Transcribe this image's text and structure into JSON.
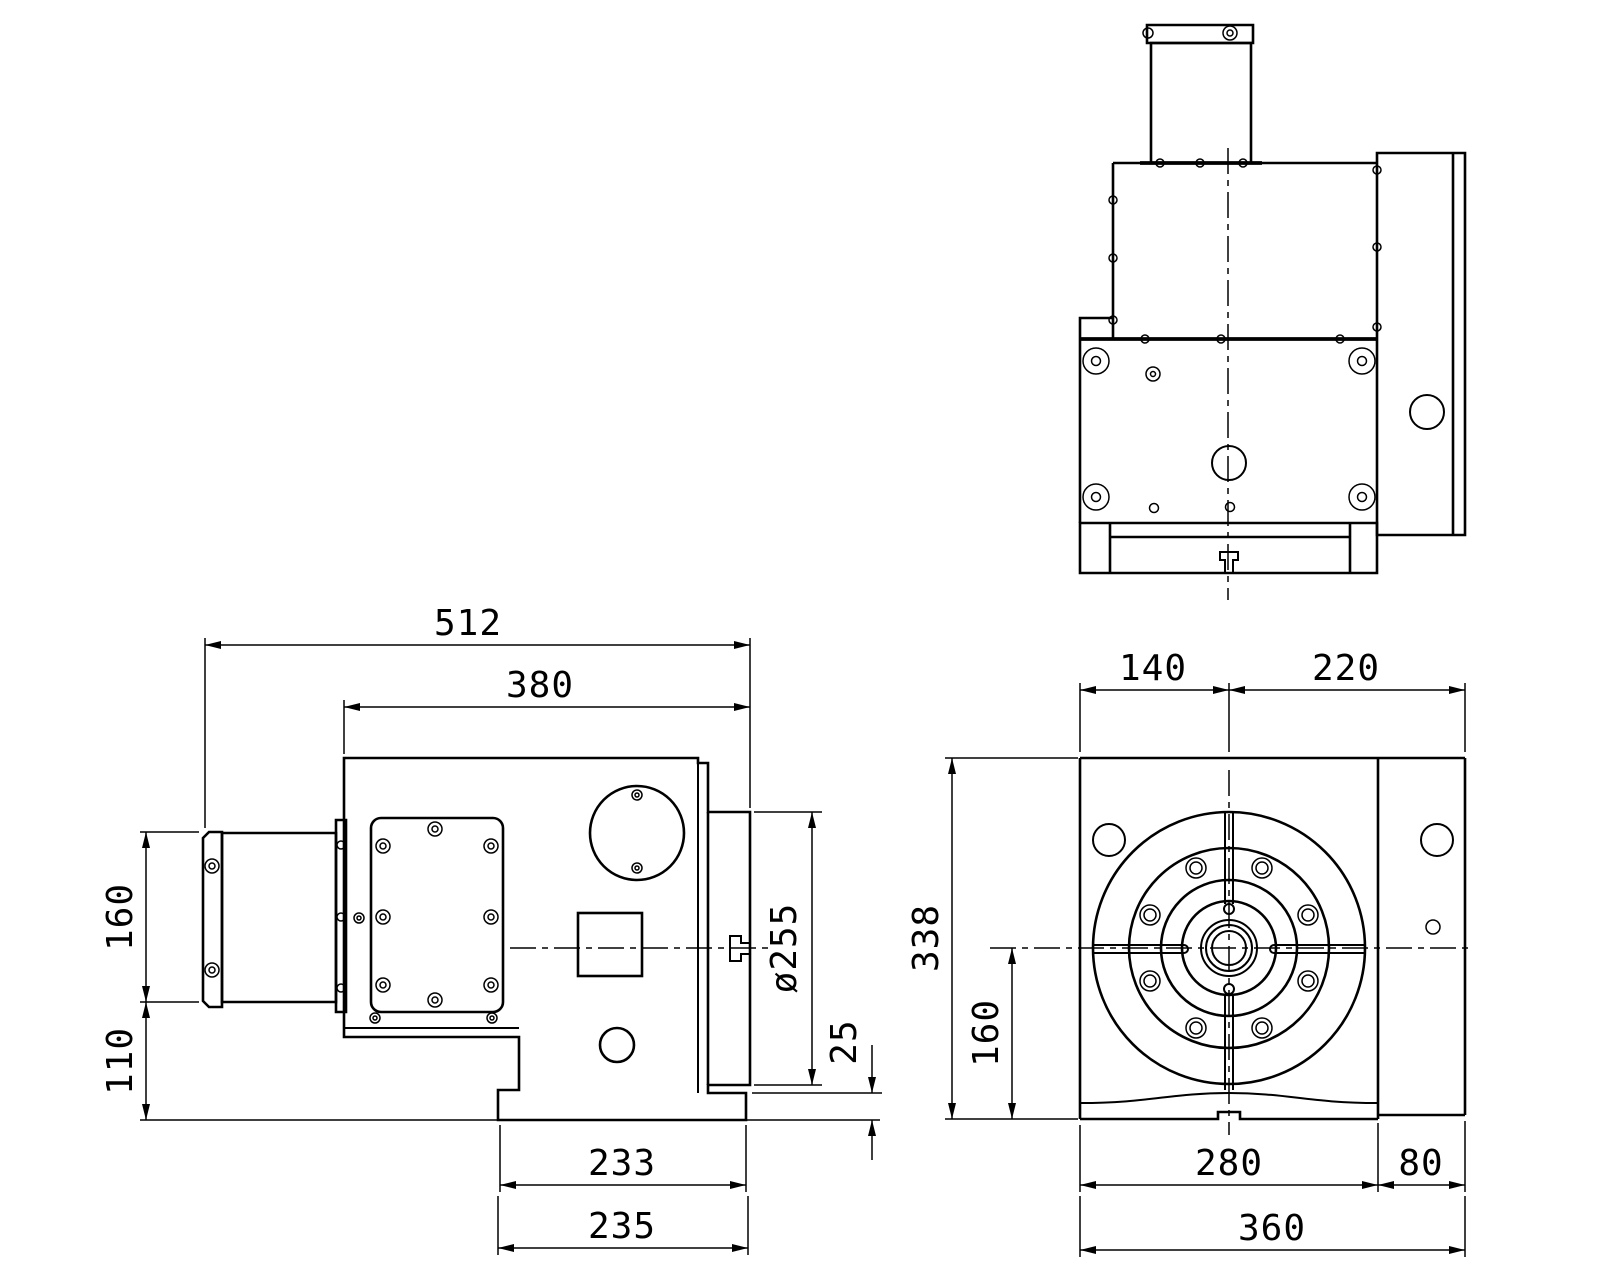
{
  "drawing": {
    "type": "engineering-orthographic-views",
    "subject": "rotary-table-unit",
    "background_color": "#ffffff",
    "line_color": "#000000",
    "views": {
      "side_view": "side view (bottom left)",
      "top_view": "top view (top right)",
      "front_view": "front view (bottom right)"
    },
    "dimensions": {
      "side": {
        "overall_width": "512",
        "body_width": "380",
        "motor_height": "160",
        "motor_to_base": "110",
        "faceplate_diameter": "ø255",
        "faceplate_clearance": "25",
        "base_top_width": "233",
        "base_bottom_width": "235"
      },
      "front": {
        "center_to_left": "140",
        "center_to_right": "220",
        "body_height": "338",
        "center_height": "160",
        "body_width": "280",
        "side_plate_width": "80",
        "overall_width": "360"
      }
    }
  }
}
